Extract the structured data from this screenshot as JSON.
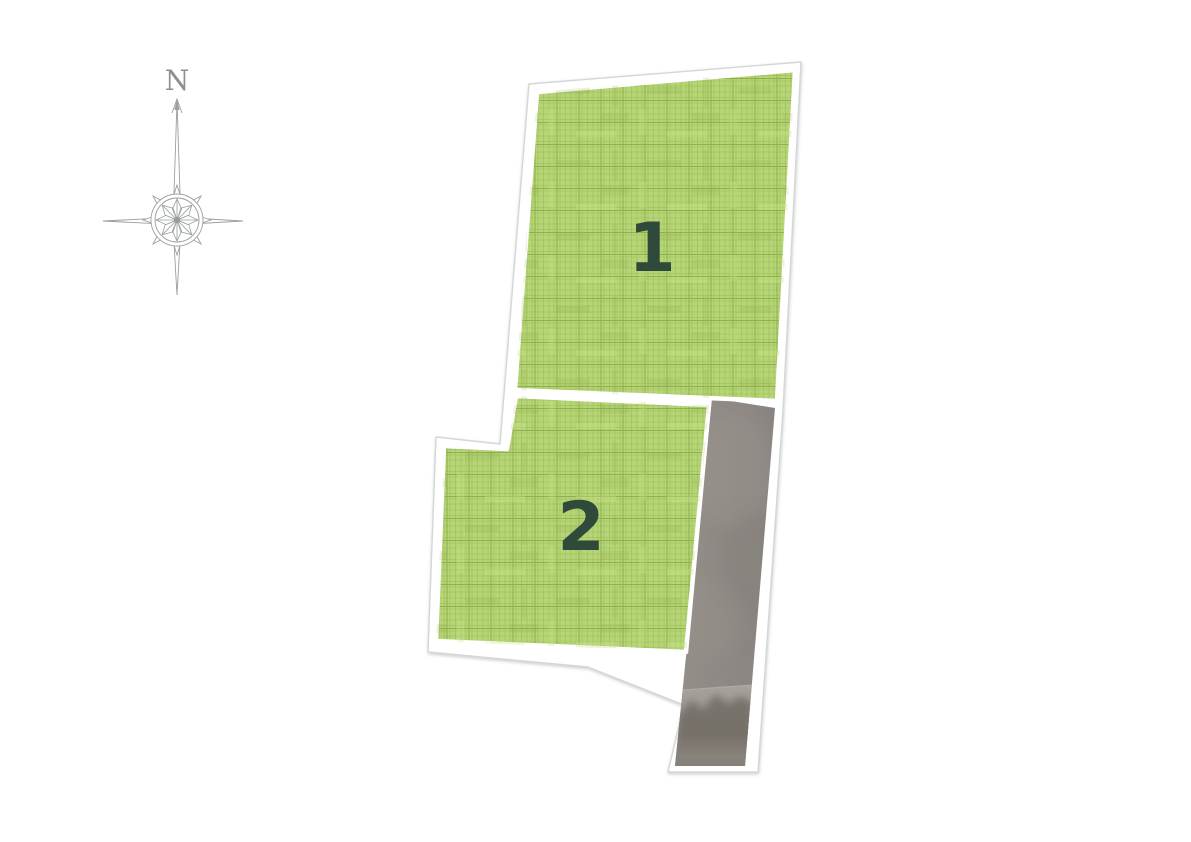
{
  "compass": {
    "north_label": "N"
  },
  "parcels": [
    {
      "number": "1"
    },
    {
      "number": "2"
    }
  ],
  "colors": {
    "parcel_green": "#b6d577",
    "hatch_line": "#9dbd5b",
    "hatch_line_dark": "#8cae4b",
    "number_green": "#2f4a3a",
    "outline_gray": "#d3d8d6",
    "road_gray": "#8f8a85",
    "road_sky": "#a8a49d",
    "road_dark": "#6b675f",
    "compass_gray": "#9aa09d"
  }
}
